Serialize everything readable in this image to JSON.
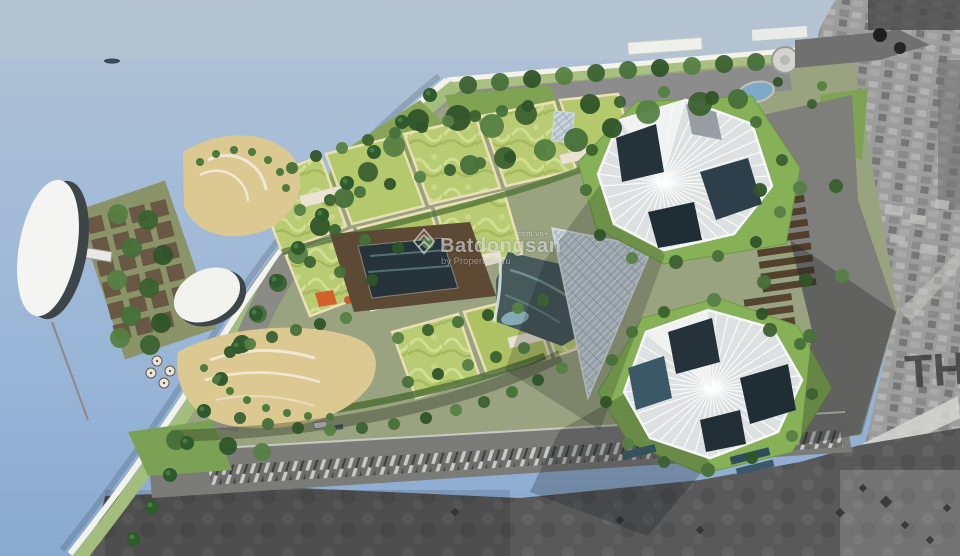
{
  "watermark": {
    "logo_icon": "batdongsan-diamond-icon",
    "brand": "Batdongsan",
    "domain_suffix": ".com.vn+",
    "byline": "by PropertyGuru"
  },
  "satellite": {
    "rooftop_label": "TH"
  },
  "colors": {
    "water": "#a6bdd8",
    "sky_band": "#b5c3d2",
    "terrace_lime": "#b4c86c",
    "lawn_green": "#86b156",
    "tree_green": "#3c6130",
    "sand": "#dcc991",
    "road_gray": "#8c8c8c",
    "tower_white": "#dde1e2",
    "tower_glass": "#26323a",
    "atrium_glass": "#b7c3cb",
    "deck_brown": "#5d4a35",
    "lagoon": "#46595b",
    "photo_light_gray": "#9d9d9d",
    "photo_dark_gray": "#565656",
    "accent_orange": "#d2622a",
    "watermark_white": "#f0f0f0"
  }
}
